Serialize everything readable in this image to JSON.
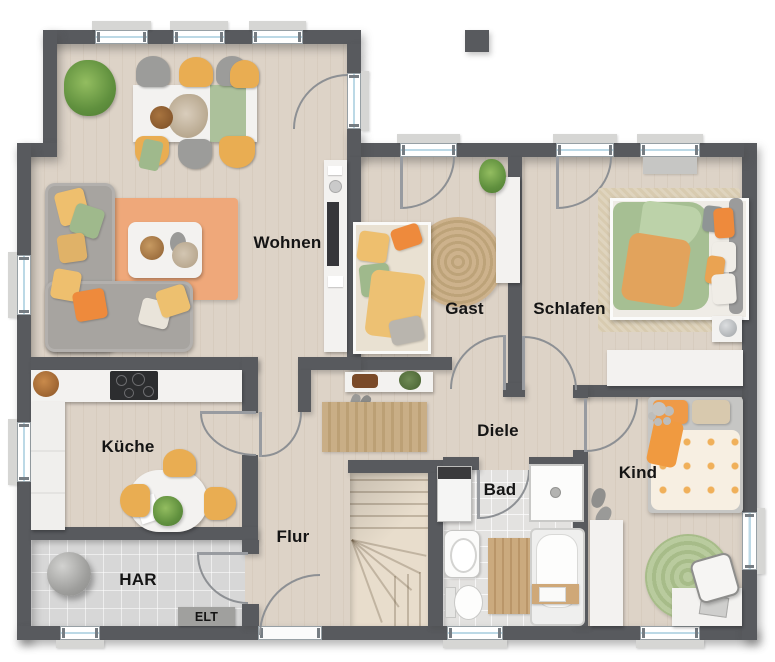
{
  "rooms": {
    "wohnen": {
      "label": "Wohnen"
    },
    "gast": {
      "label": "Gast"
    },
    "schlafen": {
      "label": "Schlafen"
    },
    "kueche": {
      "label": "Küche"
    },
    "diele": {
      "label": "Diele"
    },
    "kind": {
      "label": "Kind"
    },
    "bad": {
      "label": "Bad"
    },
    "flur": {
      "label": "Flur"
    },
    "har": {
      "label": "HAR"
    },
    "elt": {
      "label": "ELT"
    }
  },
  "colors": {
    "wall": "#585a5e",
    "wood": "#ddd3c7",
    "tile": "#d7d7d7",
    "white": "#f3f2f0",
    "glass": "#bcd9e6",
    "orange": "#ee8a3c",
    "yellow": "#e9ad52",
    "green": "#9fb98c",
    "jute": "#c9ae87"
  }
}
